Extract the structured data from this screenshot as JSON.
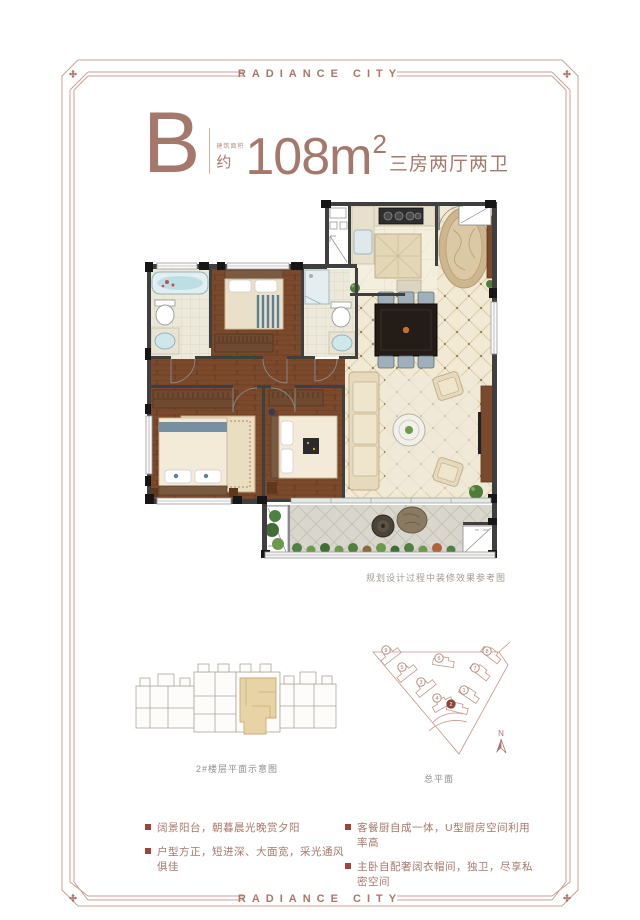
{
  "brand": {
    "header": "RADIANCE CITY",
    "footer": "RADIANCE CITY"
  },
  "title": {
    "unit_letter": "B",
    "area_label_small": "建筑面积",
    "approx": "约",
    "area_number": "108",
    "area_unit": "m",
    "area_exponent": "2",
    "room_desc": "三房两厅两卫"
  },
  "floorplan": {
    "caption": "规划设计过程中装修效果参考图"
  },
  "floor_schematic": {
    "caption": "2#楼层平面示意图"
  },
  "site_plan": {
    "caption": "总平面",
    "north": "N",
    "buildings": [
      {
        "label": "9",
        "highlighted": false
      },
      {
        "label": "5",
        "highlighted": false
      },
      {
        "label": "3",
        "highlighted": false
      },
      {
        "label": "6",
        "highlighted": false
      },
      {
        "label": "4",
        "highlighted": false
      },
      {
        "label": "2",
        "highlighted": true
      },
      {
        "label": "1",
        "highlighted": false
      },
      {
        "label": "7",
        "highlighted": false
      },
      {
        "label": "8",
        "highlighted": false
      }
    ]
  },
  "features": [
    "阔景阳台，朝暮晨光晚赏夕阳",
    "户型方正，短进深、大面宽，采光通风俱佳",
    "客餐厨自成一体，U型厨房空间利用率高",
    "主卧自配奢阔衣帽间，独卫，尽享私密空间"
  ],
  "colors": {
    "brand": "#a5786c",
    "frame": "#c8a294",
    "bullet": "#99473a",
    "wall": "#3f3f3f",
    "highlight_unit": "#e7d2a6",
    "wood_floor": "#7b4a2c",
    "cream_tile": "#f1e9d3"
  }
}
